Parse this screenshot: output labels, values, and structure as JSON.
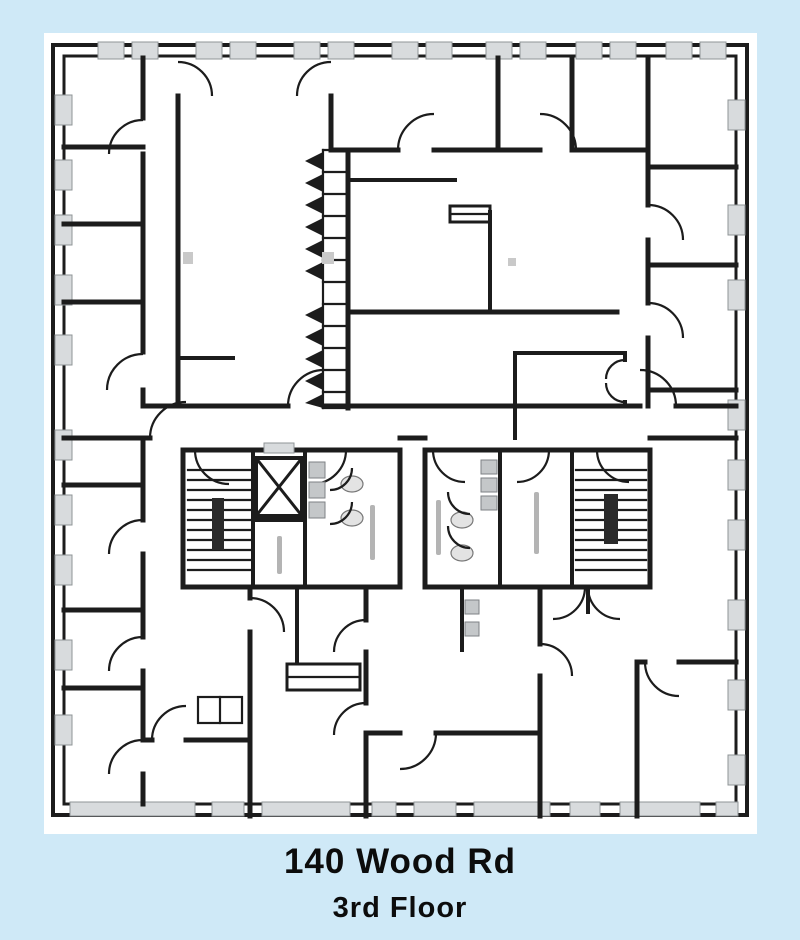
{
  "page": {
    "background_color": "#cfe9f7",
    "sheet_color": "#ffffff",
    "ink_color": "#1c1c1c",
    "window_fill": "#d8dbdd"
  },
  "caption": {
    "line1": "140 Wood Rd",
    "line2": "3rd Floor"
  },
  "plan": {
    "type": "architectural-floor-plan",
    "symbols": [
      "west-stairwell",
      "east-stairwell",
      "elevator",
      "west-restroom",
      "east-restroom",
      "accordion-partition",
      "door-swings",
      "perimeter-windows"
    ],
    "room_label_text": "illegible"
  }
}
